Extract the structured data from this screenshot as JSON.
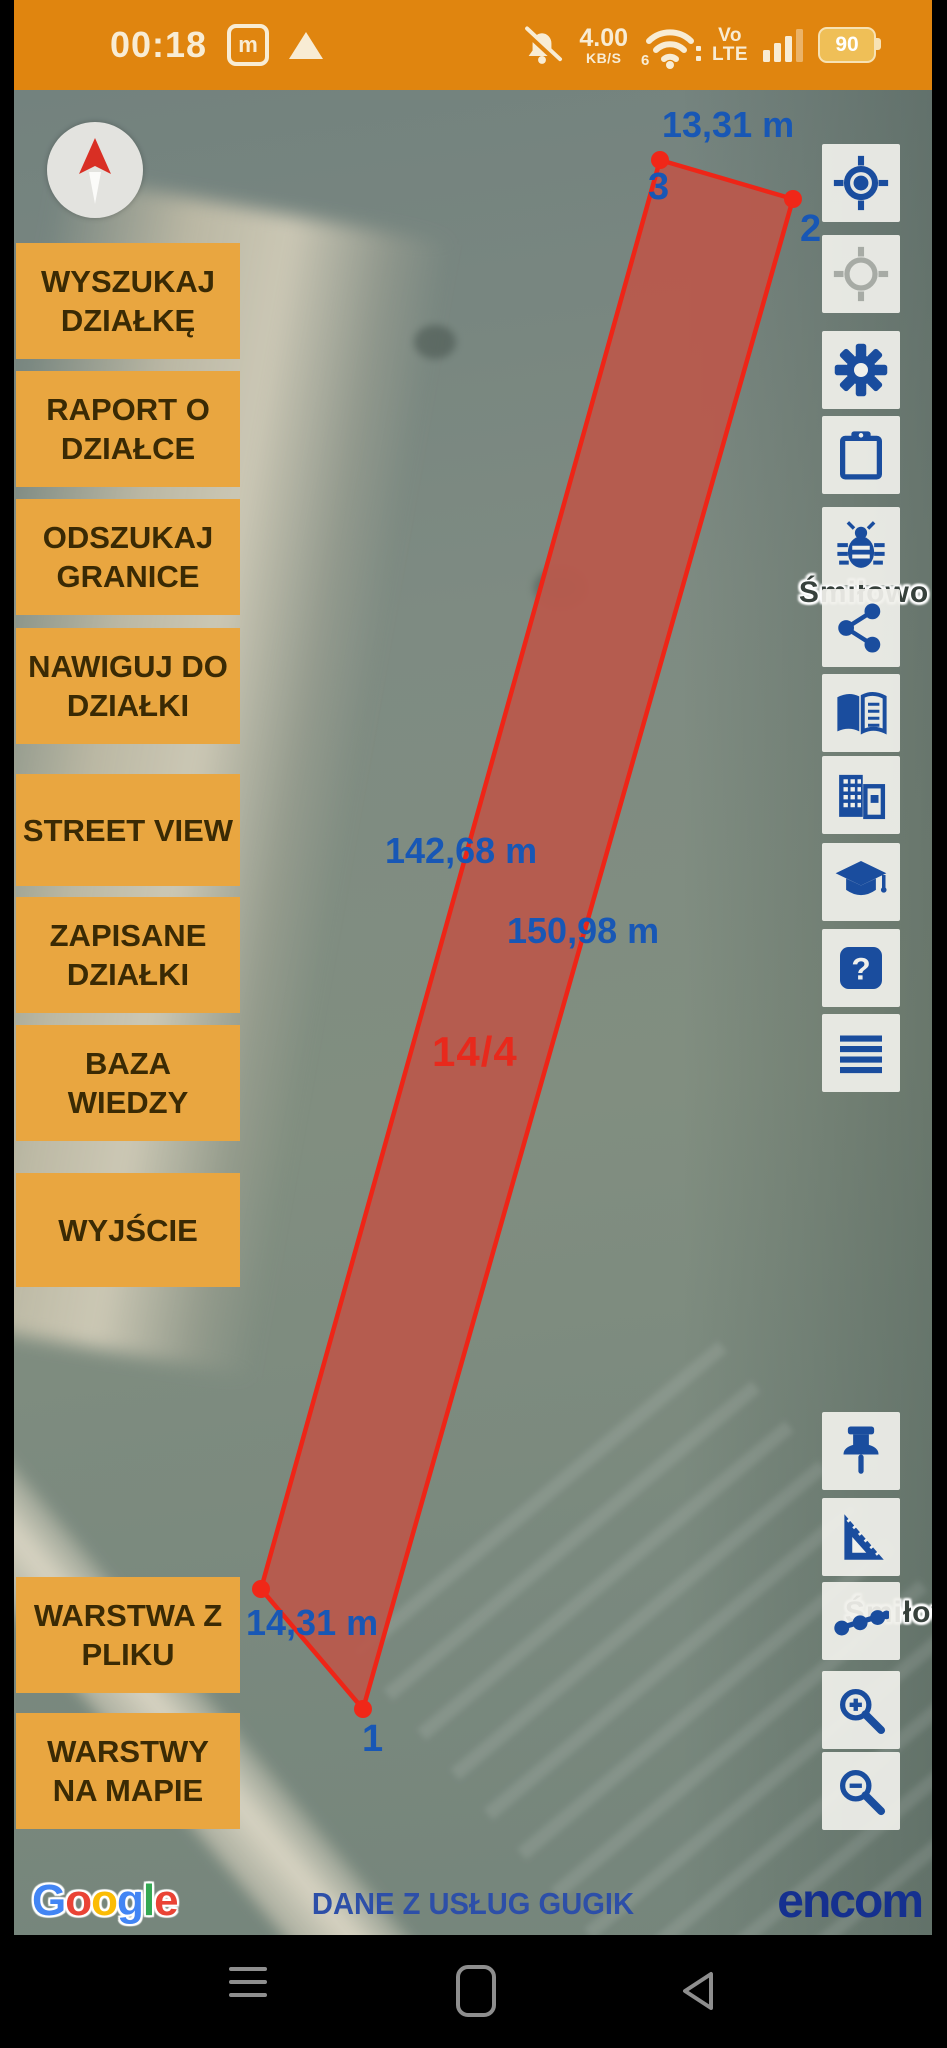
{
  "status_bar": {
    "time": "00:18",
    "sim_badge": "m",
    "speed_value": "4.00",
    "speed_unit": "KB/S",
    "wifi_band": "6",
    "network_type_line1": "Vo",
    "network_type_line2": "LTE",
    "battery_percent": "90",
    "icons": [
      "notifications-off-icon",
      "wifi-icon",
      "signal-bars-icon",
      "battery-icon"
    ]
  },
  "menu": {
    "items": [
      {
        "label": "WYSZUKAJ DZIAŁKĘ"
      },
      {
        "label": "RAPORT O DZIAŁCE"
      },
      {
        "label": "ODSZUKAJ GRANICE"
      },
      {
        "label": "NAWIGUJ DO DZIAŁKI"
      },
      {
        "label": "STREET VIEW"
      },
      {
        "label": "ZAPISANE DZIAŁKI"
      },
      {
        "label": "BAZA WIEDZY"
      },
      {
        "label": "WYJŚCIE"
      },
      {
        "label": "WARSTWA Z PLIKU"
      },
      {
        "label": "WARSTWY NA MAPIE"
      }
    ]
  },
  "map": {
    "parcel_number": "14/4",
    "edge_labels": {
      "top": "13,31 m",
      "left": "142,68 m",
      "right": "150,98 m",
      "bottom": "14,31 m"
    },
    "vertex_labels": {
      "v1": "1",
      "v2": "2",
      "v3": "3"
    },
    "place_label_top": "Śmiłowo",
    "place_label_bottom": "Śmiłowo",
    "colors": {
      "parcel_stroke": "#ee2517",
      "measurement_text": "#1857b5",
      "parcel_number_text": "#e8291c"
    }
  },
  "toolbar": {
    "icons_top": [
      "gps-fixed",
      "gps-not-fixed",
      "settings-gear",
      "clipboard",
      "bug-report",
      "share",
      "knowledge-book",
      "buildings",
      "education-cap",
      "help",
      "layers-list"
    ],
    "icons_bottom": [
      "push-pin",
      "measure-set-square",
      "polyline-points",
      "zoom-in",
      "zoom-out"
    ],
    "icon_color": "#1a4d9e",
    "inactive_icon_color": "#a7aba5"
  },
  "attribution": {
    "google_letters": [
      {
        "ch": "G",
        "color": "#4285F4"
      },
      {
        "ch": "o",
        "color": "#EA4335"
      },
      {
        "ch": "o",
        "color": "#FBBC05"
      },
      {
        "ch": "g",
        "color": "#4285F4"
      },
      {
        "ch": "l",
        "color": "#34A853"
      },
      {
        "ch": "e",
        "color": "#EA4335"
      }
    ],
    "center_text": "DANE Z USŁUG GUGIK",
    "brand": "encom"
  },
  "nav_bar": {
    "icons": [
      "menu-icon",
      "recents-square-icon",
      "back-triangle-icon"
    ]
  }
}
